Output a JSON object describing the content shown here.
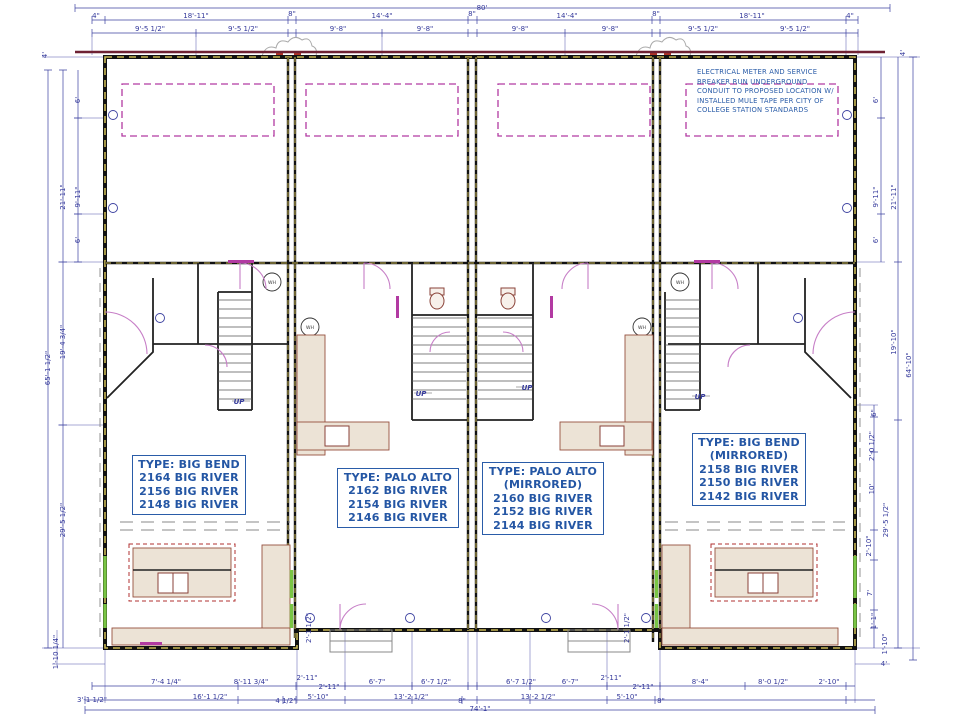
{
  "drawing": {
    "overall_top": "80'",
    "overall_bottom": "74'-1\"",
    "overall_left": "65'-1 1/2\"",
    "overall_right": "64'-10\""
  },
  "colors": {
    "dimension": "#34399b",
    "label_blue": "#2456a4",
    "wall_black": "#111111",
    "wall_hatch": "#c9b855",
    "magenta": "#b23aa2",
    "door_arc": "#c77fc7",
    "maroon": "#6e2133",
    "counter_fill": "#ece3d6",
    "counter_stroke": "#96503e",
    "window_green": "#79c544"
  },
  "units": [
    {
      "name": "unit-1",
      "lines": [
        "TYPE: BIG BEND",
        "2164 BIG RIVER",
        "2156 BIG RIVER",
        "2148 BIG RIVER"
      ]
    },
    {
      "name": "unit-2",
      "lines": [
        "TYPE: PALO ALTO",
        "2162 BIG RIVER",
        "2154 BIG RIVER",
        "2146 BIG RIVER"
      ]
    },
    {
      "name": "unit-3",
      "lines": [
        "TYPE: PALO ALTO",
        "(MIRRORED)",
        "2160 BIG RIVER",
        "2152 BIG RIVER",
        "2144 BIG RIVER"
      ]
    },
    {
      "name": "unit-4",
      "lines": [
        "TYPE: BIG BEND",
        "(MIRRORED)",
        "2158 BIG RIVER",
        "2150 BIG RIVER",
        "2142 BIG RIVER"
      ]
    }
  ],
  "electrical_note": {
    "lines": [
      "ELECTRICAL METER AND SERVICE",
      "BREAKER RUN UNDERGROUND",
      "CONDUIT TO PROPOSED LOCATION W/",
      "INSTALLED MULE TAPE PER CITY OF",
      "COLLEGE STATION STANDARDS"
    ]
  },
  "annotations": [
    {
      "t": "UP",
      "x": 239,
      "y": 404,
      "cls": "annot-up"
    },
    {
      "t": "UP",
      "x": 421,
      "y": 396,
      "cls": "annot-up"
    },
    {
      "t": "UP",
      "x": 527,
      "y": 390,
      "cls": "annot-up"
    },
    {
      "t": "UP",
      "x": 700,
      "y": 399,
      "cls": "annot-up"
    },
    {
      "t": "WH",
      "x": 272,
      "y": 284,
      "cls": "annot-wh"
    },
    {
      "t": "WH",
      "x": 310,
      "y": 329,
      "cls": "annot-wh"
    },
    {
      "t": "WH",
      "x": 680,
      "y": 284,
      "cls": "annot-wh"
    },
    {
      "t": "WH",
      "x": 642,
      "y": 329,
      "cls": "annot-wh"
    }
  ],
  "dimensions": [
    {
      "t": "80'",
      "x": 482,
      "y": 10
    },
    {
      "t": "4\"",
      "x": 96,
      "y": 18
    },
    {
      "t": "18'-11\"",
      "x": 196,
      "y": 18
    },
    {
      "t": "8\"",
      "x": 292,
      "y": 16
    },
    {
      "t": "14'-4\"",
      "x": 382,
      "y": 18
    },
    {
      "t": "8\"",
      "x": 472,
      "y": 16
    },
    {
      "t": "14'-4\"",
      "x": 567,
      "y": 18
    },
    {
      "t": "8\"",
      "x": 656,
      "y": 16
    },
    {
      "t": "18'-11\"",
      "x": 752,
      "y": 18
    },
    {
      "t": "4\"",
      "x": 850,
      "y": 18
    },
    {
      "t": "9'-5 1/2\"",
      "x": 150,
      "y": 31
    },
    {
      "t": "9'-5 1/2\"",
      "x": 243,
      "y": 31
    },
    {
      "t": "9'-8\"",
      "x": 338,
      "y": 31
    },
    {
      "t": "9'-8\"",
      "x": 425,
      "y": 31
    },
    {
      "t": "9'-8\"",
      "x": 520,
      "y": 31
    },
    {
      "t": "9'-8\"",
      "x": 610,
      "y": 31
    },
    {
      "t": "9'-5 1/2\"",
      "x": 703,
      "y": 31
    },
    {
      "t": "9'-5 1/2\"",
      "x": 795,
      "y": 31
    },
    {
      "t": "4'",
      "x": 47,
      "y": 55,
      "r": -90
    },
    {
      "t": "6'",
      "x": 80,
      "y": 100,
      "r": -90
    },
    {
      "t": "9'-11\"",
      "x": 80,
      "y": 197,
      "r": -90
    },
    {
      "t": "6'",
      "x": 80,
      "y": 240,
      "r": -90
    },
    {
      "t": "21'-11\"",
      "x": 65,
      "y": 197,
      "r": -90
    },
    {
      "t": "19'-4 3/4\"",
      "x": 65,
      "y": 342,
      "r": -90
    },
    {
      "t": "65'-1 1/2\"",
      "x": 50,
      "y": 368,
      "r": -90
    },
    {
      "t": "29'-5 1/2\"",
      "x": 65,
      "y": 520,
      "r": -90
    },
    {
      "t": "1'-10 1/4\"",
      "x": 58,
      "y": 652,
      "r": -90
    },
    {
      "t": "4'",
      "x": 905,
      "y": 53,
      "r": -90
    },
    {
      "t": "6'",
      "x": 878,
      "y": 100,
      "r": -90
    },
    {
      "t": "9'-11\"",
      "x": 878,
      "y": 197,
      "r": -90
    },
    {
      "t": "6'",
      "x": 878,
      "y": 240,
      "r": -90
    },
    {
      "t": "21'-11\"",
      "x": 896,
      "y": 197,
      "r": -90
    },
    {
      "t": "19'-10\"",
      "x": 896,
      "y": 342,
      "r": -90
    },
    {
      "t": "64'-10\"",
      "x": 911,
      "y": 365,
      "r": -90
    },
    {
      "t": "29'-5 1/2\"",
      "x": 888,
      "y": 520,
      "r": -90
    },
    {
      "t": "6\"",
      "x": 876,
      "y": 413,
      "r": -90
    },
    {
      "t": "2'-0 1/2\"",
      "x": 874,
      "y": 446,
      "r": -90
    },
    {
      "t": "10'",
      "x": 874,
      "y": 489,
      "r": -90
    },
    {
      "t": "2'-10\"",
      "x": 871,
      "y": 546,
      "r": -90
    },
    {
      "t": "7'",
      "x": 872,
      "y": 593,
      "r": -90
    },
    {
      "t": "1'-1\"",
      "x": 876,
      "y": 621,
      "r": -90
    },
    {
      "t": "1'-10\"",
      "x": 887,
      "y": 644,
      "r": -90
    },
    {
      "t": "4'",
      "x": 884,
      "y": 666
    },
    {
      "t": "7'-4 1/4\"",
      "x": 166,
      "y": 684
    },
    {
      "t": "8'-11 3/4\"",
      "x": 251,
      "y": 684
    },
    {
      "t": "2'-11\"",
      "x": 307,
      "y": 680
    },
    {
      "t": "2'-11\"",
      "x": 329,
      "y": 689
    },
    {
      "t": "6'-7\"",
      "x": 377,
      "y": 684
    },
    {
      "t": "6'-7 1/2\"",
      "x": 436,
      "y": 684
    },
    {
      "t": "6'-7 1/2\"",
      "x": 521,
      "y": 684
    },
    {
      "t": "6'-7\"",
      "x": 570,
      "y": 684
    },
    {
      "t": "2'-11\"",
      "x": 611,
      "y": 680
    },
    {
      "t": "2'-11\"",
      "x": 643,
      "y": 689
    },
    {
      "t": "8'-4\"",
      "x": 700,
      "y": 684
    },
    {
      "t": "8'-0 1/2\"",
      "x": 773,
      "y": 684
    },
    {
      "t": "2'-10\"",
      "x": 829,
      "y": 684
    },
    {
      "t": "3'-1 1/2\"",
      "x": 92,
      "y": 702
    },
    {
      "t": "16'-1 1/2\"",
      "x": 210,
      "y": 699
    },
    {
      "t": "4 1/2\"",
      "x": 286,
      "y": 703
    },
    {
      "t": "5'-10\"",
      "x": 318,
      "y": 699
    },
    {
      "t": "13'-2 1/2\"",
      "x": 411,
      "y": 699
    },
    {
      "t": "8\"",
      "x": 462,
      "y": 703
    },
    {
      "t": "13'-2 1/2\"",
      "x": 538,
      "y": 699
    },
    {
      "t": "5'-10\"",
      "x": 627,
      "y": 699
    },
    {
      "t": "8\"",
      "x": 661,
      "y": 703
    },
    {
      "t": "74'-1\"",
      "x": 480,
      "y": 711
    },
    {
      "t": "2'-1 1/2\"",
      "x": 311,
      "y": 628,
      "r": -90
    },
    {
      "t": "2'-1 1/2\"",
      "x": 629,
      "y": 628,
      "r": -90
    }
  ]
}
